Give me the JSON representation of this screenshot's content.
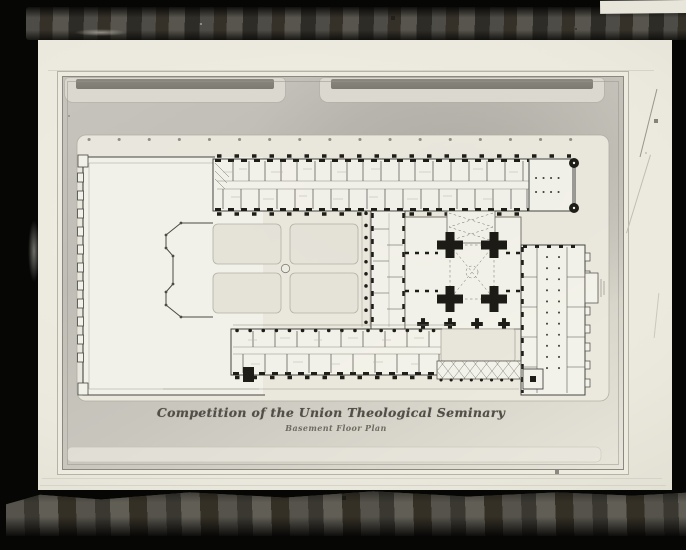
{
  "drawing": {
    "title": "Competition of the Union Theological Seminary",
    "subtitle": "Basement Floor Plan"
  },
  "colors": {
    "plate_black": "#060605",
    "exposure_band": "#46443d",
    "photo_margin": "#edebe0",
    "site_ground": "#c4c2ba",
    "building_paper": "#f5f4ec",
    "ink_line": "#3f3e3a",
    "poche_black": "#16150f",
    "lawn_panel": "#e7e5da"
  }
}
